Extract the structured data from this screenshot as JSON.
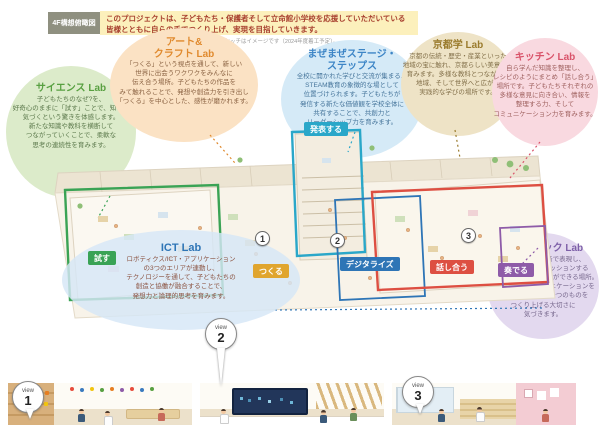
{
  "header": {
    "tag": "4F構想俯瞰図",
    "message_line1": "このプロジェクトは、子どもたち・保護者そして立命館小学校を応援していただいている",
    "message_line2": "皆様とともに自らの手でつくり上げ、実現を目指していきます。",
    "note": "この構想スケッチはイメージです（2024年度着工予定）。"
  },
  "bubbles": {
    "science": {
      "title": "サイエンス Lab",
      "lines": [
        "子どもたちのなぜ?を、",
        "好奇心のままに「試す」ことで、知る・",
        "気づくという驚きを体感します。",
        "新たな知識や教科を横断して",
        "つながっていくことで、柔軟な",
        "思考の連続性を育みます。"
      ]
    },
    "art": {
      "title1": "アート&",
      "title2": "クラフト Lab",
      "lines": [
        "「つくる」という視点を通して、新しい",
        "世界に出会うワクワクをみんなに",
        "伝え合う場所。子どもたちの作品を",
        "みて触れることで、発想や創造力を引き出し",
        "「つくる」を中心とした、感性が磨かれます。"
      ]
    },
    "maze": {
      "title1": "まぜまぜステージ・",
      "title2": "ステップス",
      "lines": [
        "全校に開かれた学びと交流が集まる、",
        "STEAM教育の象徴的な場として",
        "位置づけられます。子どもたちが",
        "発信する新たな価値観を学校全体に",
        "共有することで、共創力と",
        "リーダーシップ力を育みます。"
      ]
    },
    "kyoto": {
      "title": "京都学 Lab",
      "lines": [
        "京都の伝統・歴史・産業といった",
        "地域の宝に触れ、京都らしい美意識を",
        "育みます。多様な教科とつながり、",
        "地域、そして世界へと広がる",
        "実践的な学びの場所です。"
      ]
    },
    "kitchen": {
      "title": "キッチン Lab",
      "lines": [
        "自ら学んだ知識を整理し、",
        "レシピのようにまとめ「話し合う」",
        "場所です。子どもたちそれぞれの",
        "多様な意見に向き合い、情報を",
        "整理する力、そして",
        "コミュニケーション力を育みます。"
      ]
    },
    "music": {
      "title": "ミュージック Lab",
      "lines": [
        "自分のおもいを音で表現し、",
        "みんなで音楽をセッションする",
        "ように「奏でる」ことができる場所。",
        "言葉を超えたコミュニケーションを",
        "通して、みんなで一つのものを",
        "つくり上げる大切さに",
        "気づきます。"
      ]
    },
    "ict": {
      "title": "ICT Lab",
      "lines": [
        "ロボティクス/ICT・アプリケーション",
        "の3つのエリアが連動し、",
        "テクノロジーを通して、子どもたちの",
        "創造と協働が融合することで、",
        "発想力と論理的思考を育みます。"
      ]
    }
  },
  "plan": {
    "chips": {
      "tamesu": "試す",
      "tsukuru": "つくる",
      "happyo": "発表する",
      "digitize": "デジタライズ",
      "hanashiau": "話し合う",
      "kanaderu": "奏でる"
    },
    "markers": {
      "m1": "1",
      "m2": "2",
      "m3": "3"
    }
  },
  "views": {
    "label": "view",
    "v1": "1",
    "v2": "2",
    "v3": "3"
  },
  "colors": {
    "header_tag_bg": "#8f9080",
    "header_box_bg": "#fcf0bc",
    "header_text": "#a8402f",
    "science": "#58a041",
    "art": "#e08a2e",
    "maze": "#3d85c6",
    "kyoto": "#9a7b2d",
    "kitchen": "#d9536a",
    "music": "#7d5fa8",
    "ict": "#2e75b6",
    "chip_tamesu": "#3aa355",
    "chip_tsukuru": "#e0a52e",
    "chip_happyo": "#2aa7c9",
    "chip_digitize": "#2e75b6",
    "chip_hanashiau": "#dd4f42",
    "chip_kanaderu": "#8e5ba8"
  }
}
